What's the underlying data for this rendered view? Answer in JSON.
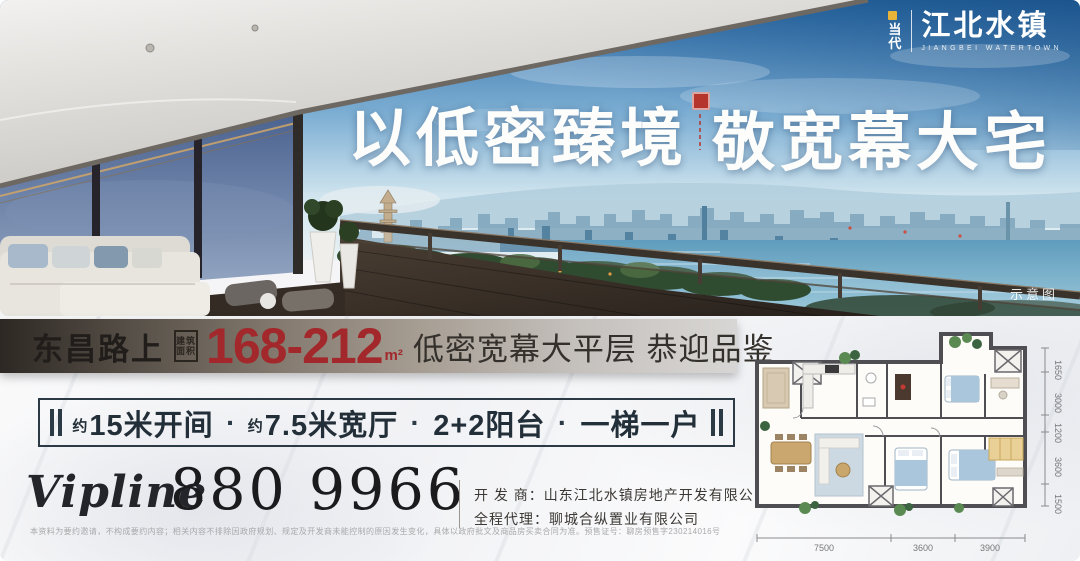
{
  "logo": {
    "brand_top": "当",
    "brand_bottom": "代",
    "name": "江北水镇",
    "subtitle": "JIANGBEI WATERTOWN"
  },
  "hero": {
    "headline_left": "以低密臻境",
    "headline_right": "敬宽幕大宅",
    "photo_tag": "示意图"
  },
  "info_bar": {
    "location": "东昌路上",
    "stamp_line1": "建筑",
    "stamp_line2": "面积",
    "area_range": "168-212",
    "area_unit": "m²",
    "tagline": "低密宽幕大平层 恭迎品鉴"
  },
  "features": {
    "separator": "·",
    "items": [
      {
        "prefix": "约",
        "label": "15米开间"
      },
      {
        "prefix": "约",
        "label": "7.5米宽厅"
      },
      {
        "prefix": "",
        "label": "2+2阳台"
      },
      {
        "prefix": "",
        "label": "一梯一户"
      }
    ]
  },
  "contact": {
    "vipline_label": "Vipline",
    "phone": "880 9966"
  },
  "company": {
    "developer_label": "开 发 商：",
    "developer_name": "山东江北水镇房地产开发有限公司",
    "agent_label": "全程代理：",
    "agent_name": "聊城合纵置业有限公司"
  },
  "disclaimer": "本资料为要约邀请，不构成要约内容；相关内容不排除因政府规划、规定及开发商未能控制的原因发生变化，具体以政府批文及商品房买卖合同为准。预售证号：聊房预售字230214016号",
  "floorplan": {
    "dims_bottom": [
      "7500",
      "3600",
      "3900"
    ],
    "dims_right": [
      "1650",
      "3000",
      "1200",
      "3600",
      "1500"
    ]
  },
  "colors": {
    "accent_red": "#a2282b",
    "seal_red": "#b5352c",
    "navy": "#2c3a46",
    "bar_dark": "#2e2824",
    "bar_light": "#d8d6d4",
    "logo_yellow": "#e8b53a"
  }
}
